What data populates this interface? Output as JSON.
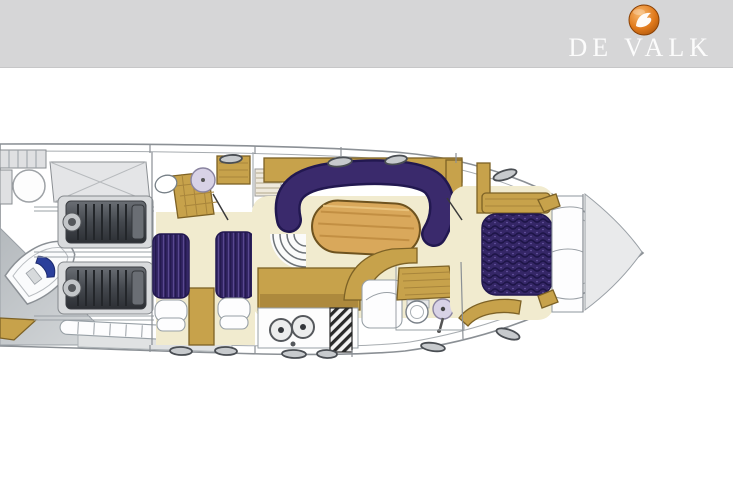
{
  "brand": {
    "name": "DE VALK",
    "logo": "falcon-logo-icon"
  },
  "floorplan": {
    "kind": "yacht accommodation deck plan",
    "regions": [
      "swim-platform",
      "tender-garage",
      "engine-room",
      "aft-twin-cabin",
      "aft-head",
      "companionway-stairs",
      "salon-settee",
      "salon-table",
      "galley",
      "forward-head",
      "forward-cabin-island-berth",
      "foredeck"
    ]
  },
  "colors": {
    "banner": "#d6d6d7",
    "brand-text": "#fcfcfc",
    "logo-orange": "#e0791b",
    "hull-line": "#8b9095",
    "deck-gray": "#e9eaeb",
    "wedge-gray": "#c6cacd",
    "cream": "#f1ebcf",
    "gold": "#c7a24b",
    "gold-dark": "#7d6226",
    "gold-shade": "#a8853b",
    "purple": "#3a2a6c",
    "purple-dark": "#221850",
    "lavender": "#d8d2e6",
    "table-wood": "#d9a85b",
    "engine-dark": "#44484e",
    "dinghy-blue": "#2b3f9b"
  }
}
